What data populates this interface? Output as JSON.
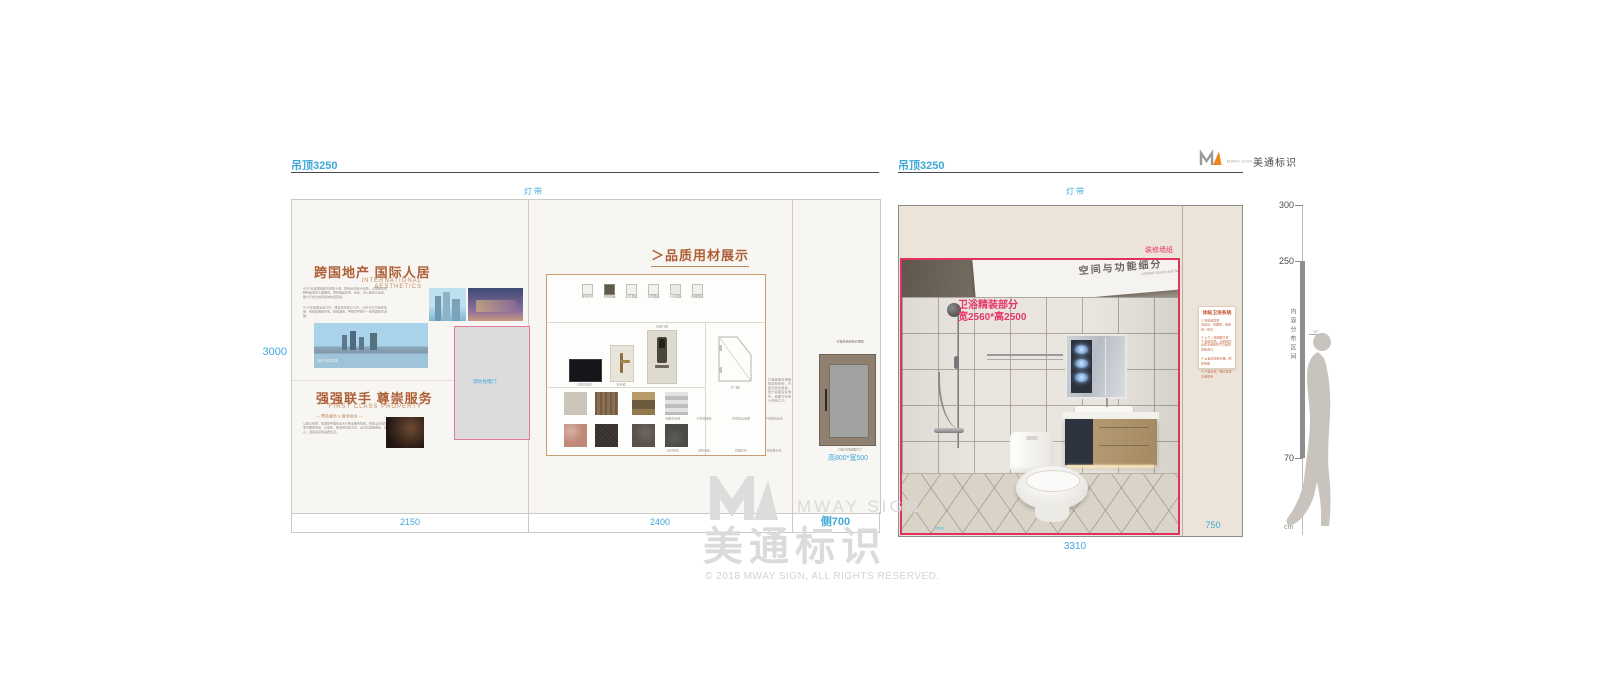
{
  "brand": {
    "logo_en": "MWAY SIGN",
    "logo_cn": "美通标识",
    "watermark_en": "MWAY SIGN",
    "watermark_cn": "美通标识",
    "copyright": "© 2018 MWAY SIGN, ALL RIGHTS RESERVED."
  },
  "left_panel": {
    "ceiling_label": "吊顶3250",
    "light_label": "灯带",
    "height_dim": "3000",
    "dim_cells": [
      "2150",
      "2400",
      "侧700"
    ],
    "brand_wall": {
      "title1": "跨国地产 国际人居",
      "subtitle1": "INTERNATIONAL AESTHETICS",
      "body1a": "HG产业集团深耕湾区数十载，联袂全球设计资源，以国际化视野缔造城市人居典范，项目涵盖住宅、商业、办公等多元业态，致力于成为世界级城市运营商。",
      "body1b": "2017年集团全新力作，择址城市核心门户，以约42万方综合体量，构筑集精装住宅、星级酒店、甲级写字楼于一体的国际生活圈。",
      "img_caption": "城市湾区实景图",
      "title2": "强强联手 尊崇服务",
      "subtitle2": "FIRST CLASS PROPERTY",
      "tagline2": "— 菁英服务 & 尊享物业 —",
      "body2": "以匠心筑家，集团联手国际五大行物业服务机构，构建全天候管家式服务体系，从安防、保洁到社区文化，全方位营造尊崇、安心、温度并存的品质生活。",
      "fire_door_label": "消防栓暗门"
    },
    "materials": {
      "heading_arrow": "＞",
      "heading": "品质用材展示",
      "switches": [
        {
          "label": "单控开关",
          "color": "#f3f1ec"
        },
        {
          "label": "调色面板",
          "color": "#5f5b49"
        },
        {
          "label": "五孔插座",
          "color": "#f3f1ec"
        },
        {
          "label": "空调插座",
          "color": "#f3f1ec"
        },
        {
          "label": "USB插座",
          "color": "#eceae4"
        },
        {
          "label": "网络插座",
          "color": "#f3f1ec"
        }
      ],
      "screen_label": "可视对讲机",
      "handle_label": "执手锁",
      "lock_label": "智能门锁",
      "door_label": "户门图",
      "swatch_rows": [
        [
          {
            "label": "墙面仿石砖",
            "color": "#ccc5b9"
          },
          {
            "label": "木纹饰面板",
            "color": "#8a6f52"
          },
          {
            "label": "古铜拉丝金属",
            "color": "#9c8761"
          },
          {
            "label": "不锈钢拉丝条",
            "color": "#d6d6d6"
          }
        ],
        [
          {
            "label": "石材拼花",
            "color": "#c08877"
          },
          {
            "label": "深色地毯",
            "color": "#352f2b"
          },
          {
            "label": "烧面石材",
            "color": "#5a524a"
          },
          {
            "label": "芝麻黑石材",
            "color": "#4c4a45"
          }
        ]
      ],
      "side_note": "灯箱画面采用磁吸软膜结构，内容可随时更换，便于后期运营维护，画面均采用UV喷绘工艺。"
    },
    "side_zone": {
      "cabinet_top_note": "灯箱开启结构示意图",
      "cabinet_bottom_note": "灯箱可视画面尺寸",
      "cabinet_size": "高800*宽500"
    }
  },
  "right_panel": {
    "ceiling_label": "吊顶3250",
    "light_label": "灯带",
    "wallpaper_label": "装修墙纸",
    "photo": {
      "caption1": "卫浴精装部分",
      "caption2": "宽2560*高2500",
      "board_cn": "空间与功能细分",
      "board_en": "Limited space and functional subdivision",
      "bottom_dim": "2560"
    },
    "card": {
      "title": "体贴卫浴系统",
      "lines": [
        "① 智能浴室柜",
        "洗漱台、镜面柜、收纳格一体化",
        "② 上下一体暗藏灯带",
        "③ 恒温花洒，全铜阀芯",
        "全套五金配件均为品牌原装进口",
        "④ 全自动智能马桶，即热除菌",
        "⑤ 干湿分离，细分舒适卫浴空间"
      ]
    },
    "bottom_dim": "3310",
    "side_dim": "750"
  },
  "ruler": {
    "ticks": [
      "300",
      "250",
      "70"
    ],
    "zone_label": "内容分布区间",
    "figure_height": "180",
    "unit": "cm"
  }
}
